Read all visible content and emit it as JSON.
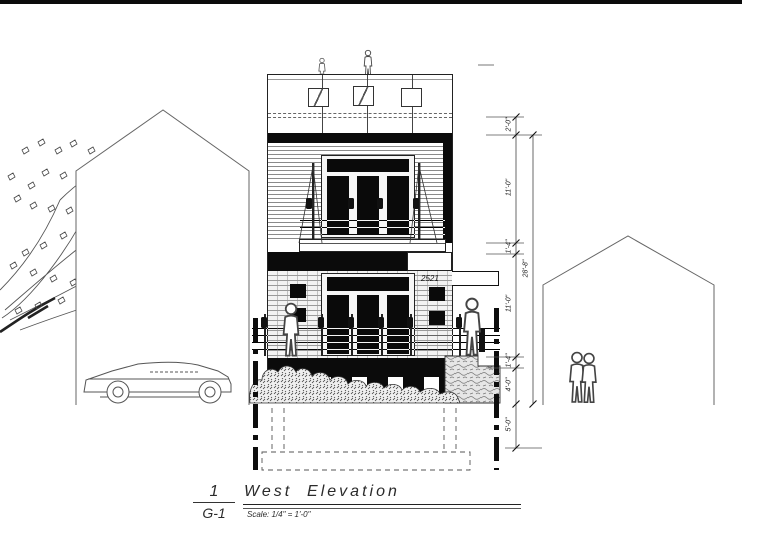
{
  "title_block": {
    "detail_number": "1",
    "sheet_ref": "G-1",
    "title": "West  Elevation",
    "scale_note": "Scale: 1/4\" = 1'-0\""
  },
  "building": {
    "house_number": "2521"
  },
  "dimensions": {
    "overall": "28'-8\"",
    "segments": [
      "2'-0\"",
      "11'-0\"",
      "1'-4\"",
      "11'-0\"",
      "1'-4\"",
      "4'-0\"",
      "5'-0\""
    ]
  },
  "colors": {
    "ink": "#0b0b0b",
    "line_gray": "#555555",
    "paper": "#ffffff"
  }
}
